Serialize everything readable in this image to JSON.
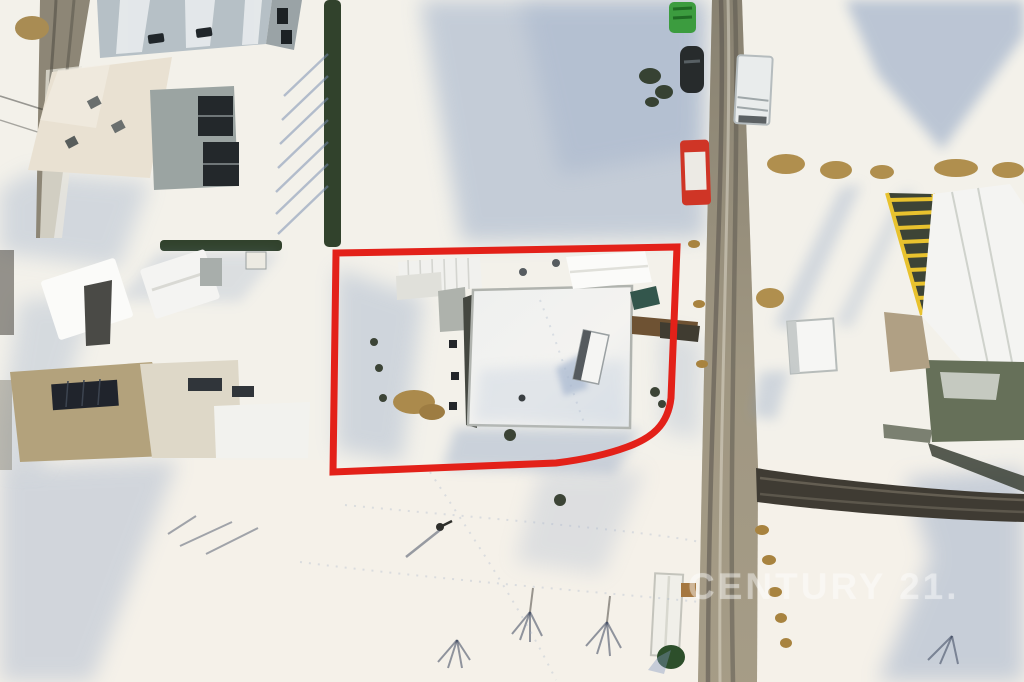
{
  "scene": {
    "description": "Winter aerial drone photograph of a snow-covered rural plot; a red outline marks the property boundary around a large flat-roof building and adjacent sheds; a road with vehicles runs along the right side; neighbouring houses on the left and a roof under construction with yellow trusses on the right; long blue shadows over snow fields with bare trees.",
    "season_label": "snow"
  },
  "overlay": {
    "boundary_name": "property-boundary",
    "boundary_color": "#e32119"
  },
  "watermark": {
    "text": "CENTURY 21.",
    "color": "#ffffff",
    "opacity": "0.40"
  },
  "palette": {
    "snow_sunlit": "#f3f1ea",
    "snow_shadow_blue": "#7f97bd",
    "road_main": "#a39a85",
    "road_left": "#8d8676",
    "driveway_dark": "#3f3b33",
    "hedge_green": "#31422c",
    "roof_metal_blue": "#b6c0c6",
    "roof_cream": "#e9e1d2",
    "roof_tan": "#b3a27c",
    "roof_snow_white": "#f3f3f1",
    "truss_yellow": "#e8c22e",
    "truss_interior": "#3d4436",
    "vehicle_red": "#cf3526",
    "vehicle_green": "#3c9c3f",
    "wall_brown": "#6e5233",
    "solar_panel_dark": "#20242c",
    "teal_roof": "#33564c"
  }
}
